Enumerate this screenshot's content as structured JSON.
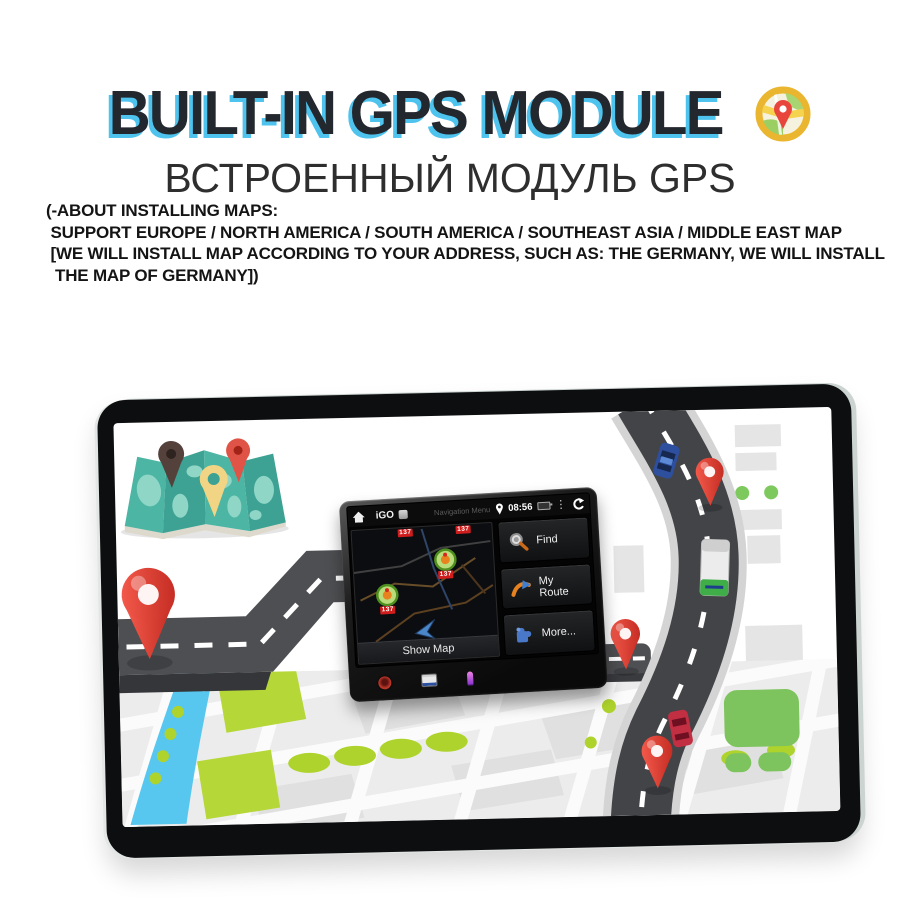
{
  "header": {
    "title": "BUILT-IN GPS MODULE",
    "subtitle_ru": "ВСТРОЕННЫЙ МОДУЛЬ GPS",
    "notes": [
      "(-ABOUT INSTALLING MAPS:",
      " SUPPORT EUROPE / NORTH AMERICA / SOUTH AMERICA / SOUTHEAST ASIA / MIDDLE EAST MAP",
      " [WE WILL INSTALL MAP ACCORDING TO YOUR ADDRESS, SUCH AS: THE GERMANY, WE WILL INSTALL",
      "  THE MAP OF GERMANY])"
    ]
  },
  "nav_unit": {
    "app_name": "iGO",
    "screen_title": "Navigation Menu",
    "time": "08:56",
    "buttons": [
      {
        "label": "Find",
        "icon": "magnifier-icon"
      },
      {
        "label": "My Route",
        "icon": "route-arrow-icon"
      },
      {
        "label": "More...",
        "icon": "puzzle-icon"
      }
    ],
    "show_map_label": "Show Map",
    "camera_tag": "137"
  },
  "colors": {
    "title_shadow_cyan": "#4ec3ee",
    "pin_red": "#e8463c",
    "map_teal": "#41a796",
    "park_lime": "#b5d737",
    "park_green": "#7ec45e",
    "river_blue": "#57c7ef",
    "road_gray": "#4a4b4e"
  }
}
